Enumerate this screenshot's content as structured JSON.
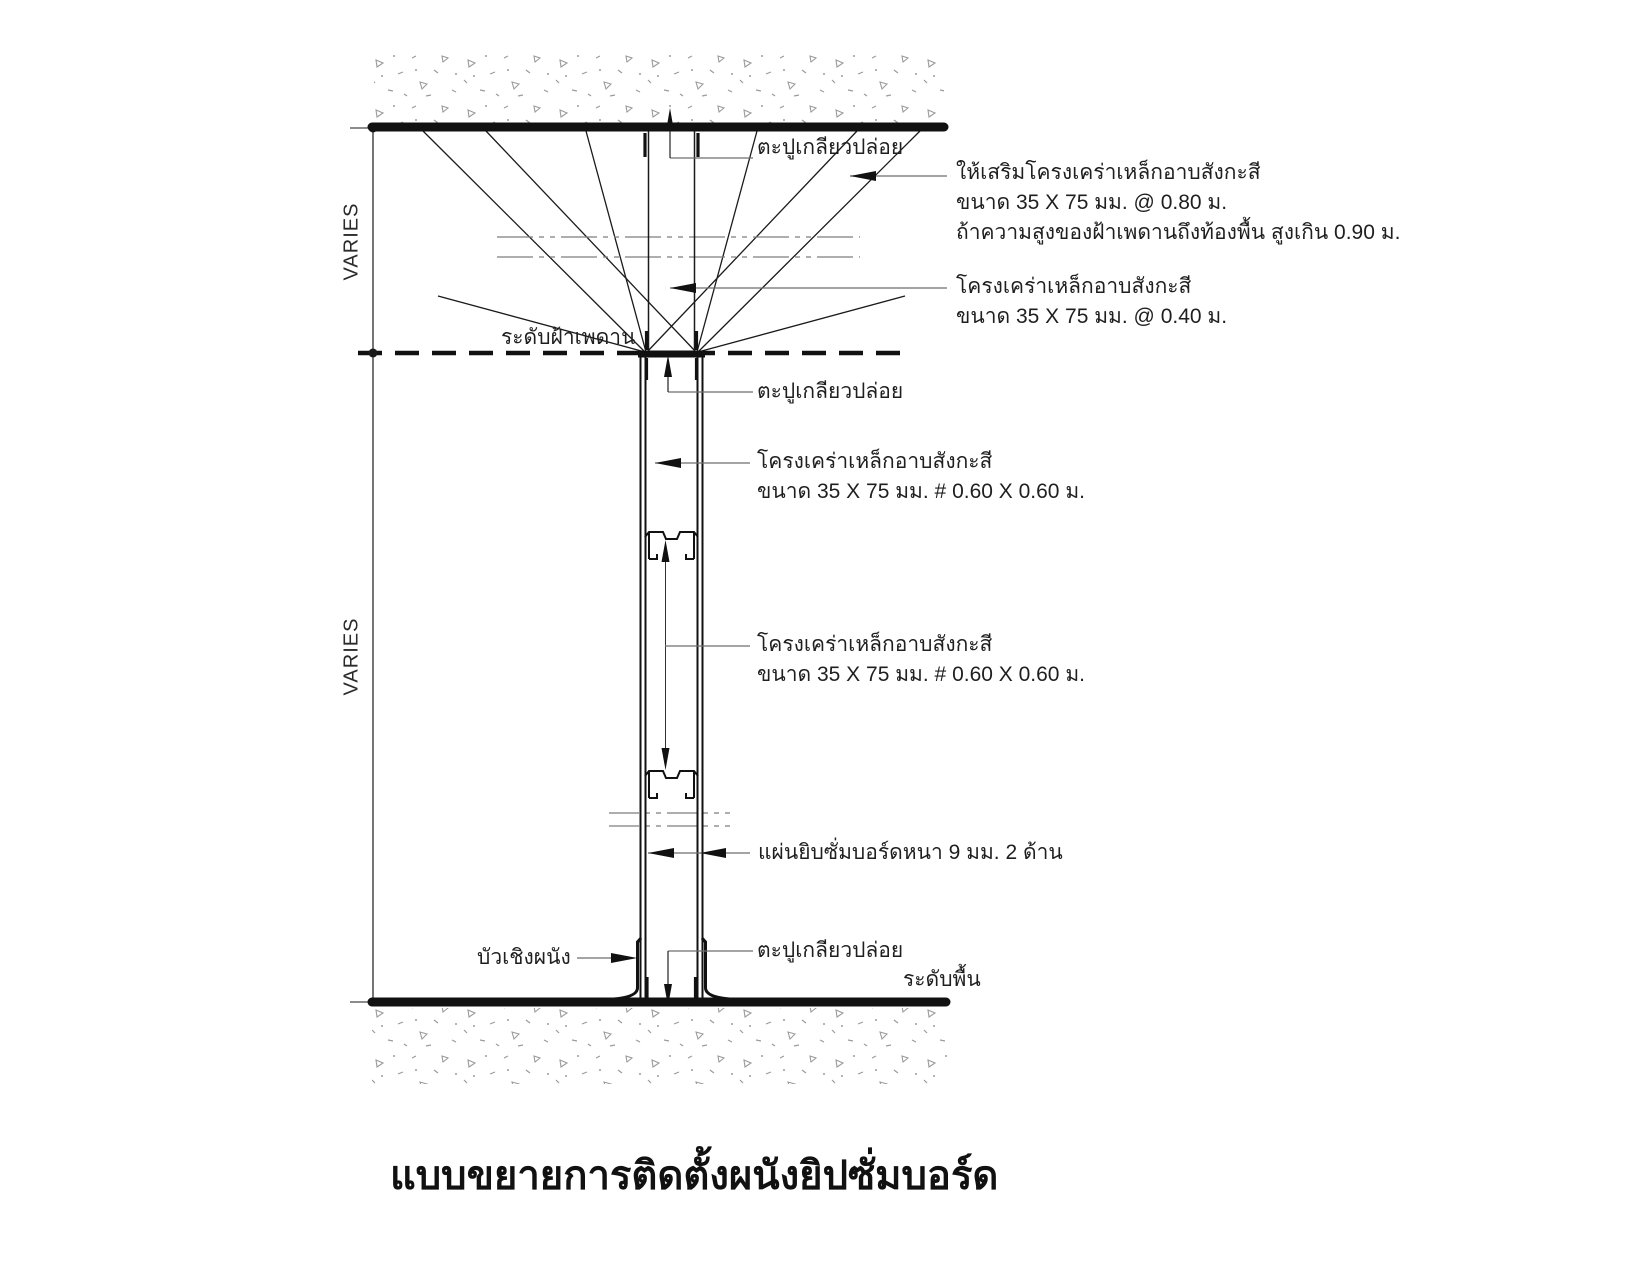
{
  "drawing": {
    "title": "แบบขยายการติดตั้งผนังยิปซั่มบอร์ด",
    "dim_varies_upper": "VARIES",
    "dim_varies_lower": "VARIES",
    "level_ceiling": "ระดับฝ้าเพดาน",
    "level_floor": "ระดับพื้น",
    "ann_screw_top": "ตะปูเกลียวปล่อย",
    "ann_brace_1": "ให้เสริมโครงเคร่าเหล็กอาบสังกะสี",
    "ann_brace_2": "ขนาด 35 X 75 มม. @ 0.80 ม.",
    "ann_brace_3": "ถ้าความสูงของฝ้าเพดานถึงท้องพื้น สูงเกิน 0.90 ม.",
    "ann_runner_1": "โครงเคร่าเหล็กอาบสังกะสี",
    "ann_runner_2": "ขนาด 35 X 75 มม. @ 0.40 ม.",
    "ann_screw_ceiling": "ตะปูเกลียวปล่อย",
    "ann_stud_upper_1": "โครงเคร่าเหล็กอาบสังกะสี",
    "ann_stud_upper_2": "ขนาด 35 X 75 มม. # 0.60 X 0.60 ม.",
    "ann_stud_lower_1": "โครงเคร่าเหล็กอาบสังกะสี",
    "ann_stud_lower_2": "ขนาด 35 X 75 มม. # 0.60 X 0.60 ม.",
    "ann_gypsum": "แผ่นยิบซั่มบอร์ดหนา 9 มม. 2 ด้าน",
    "ann_skirting": "บัวเชิงผนัง",
    "ann_screw_bottom": "ตะปูเกลียวปล่อย",
    "colors": {
      "ink": "#1a1a1a",
      "leader": "#6e6e6e",
      "hatch": "#9b9b9b",
      "paper": "#ffffff"
    }
  }
}
